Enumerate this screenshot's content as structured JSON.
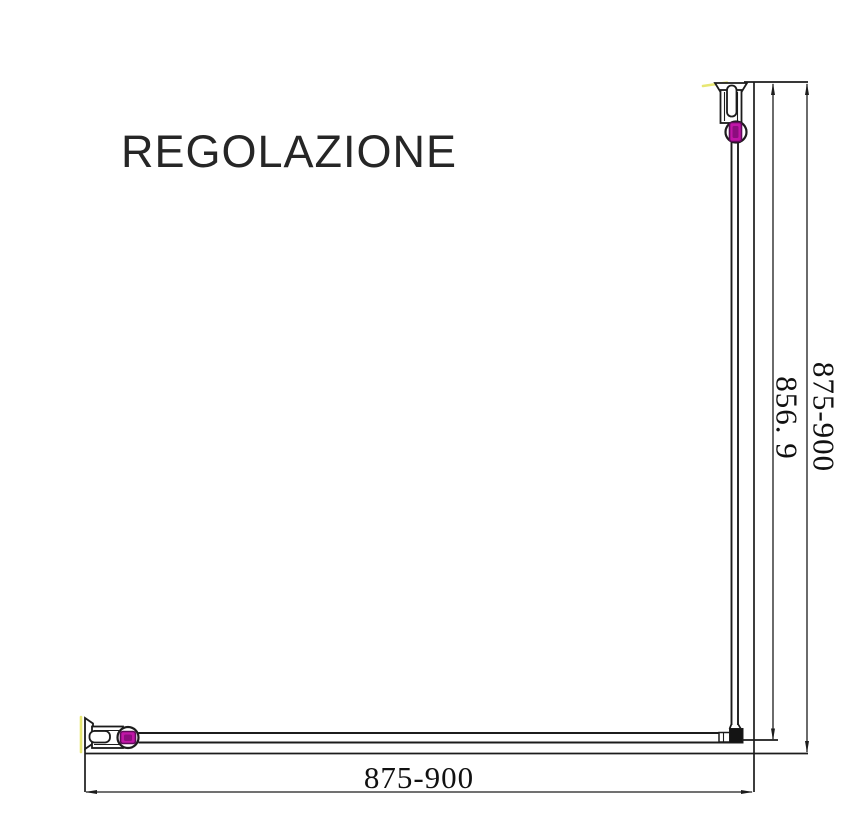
{
  "title": "REGOLAZIONE",
  "dimensions": {
    "width_bottom": "875-900",
    "height_outer": "875-900",
    "height_glass": "856. 9"
  },
  "colors": {
    "line": "#1c1c1c",
    "accent_magenta": "#c216a8",
    "accent_magenta_dark": "#8c0d7e",
    "highlight_yellow": "#e3e35a"
  },
  "icons": {
    "top_fitting": "wall-profile-clamp-icon",
    "left_fitting": "wall-profile-clamp-icon",
    "corner_fitting": "corner-connector-icon"
  }
}
